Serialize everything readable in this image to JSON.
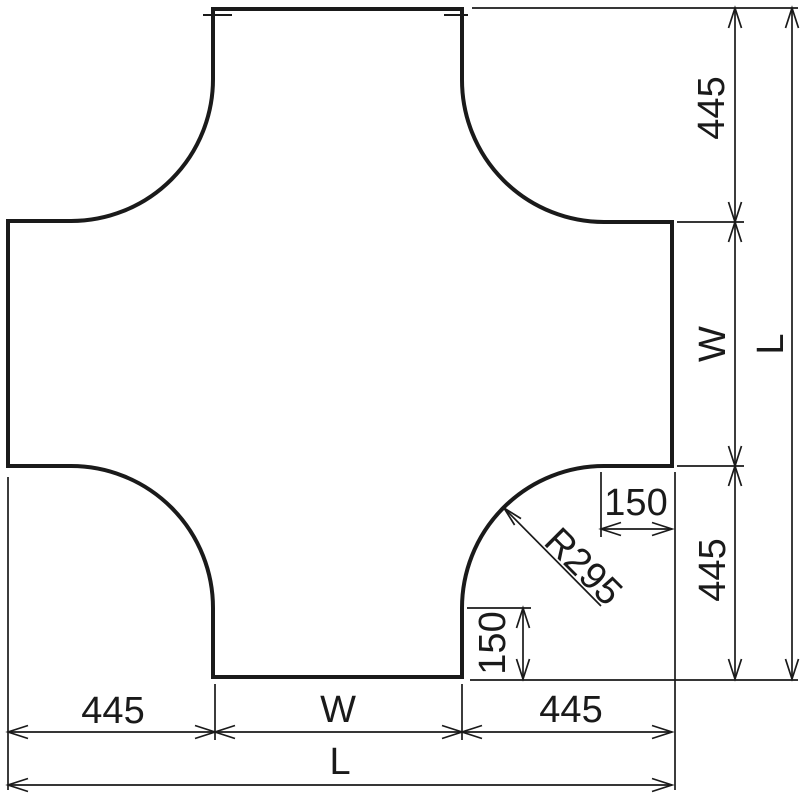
{
  "colors": {
    "line": "#1a1a1a",
    "background": "#ffffff"
  },
  "labels": {
    "right_445_top": "445",
    "right_w": "W",
    "right_445_bottom": "445",
    "right_l": "L",
    "bottom_445_left": "445",
    "bottom_w": "W",
    "bottom_445_right": "445",
    "bottom_l": "L",
    "corner_150_horizontal": "150",
    "corner_150_vertical": "150",
    "corner_radius": "R295"
  }
}
